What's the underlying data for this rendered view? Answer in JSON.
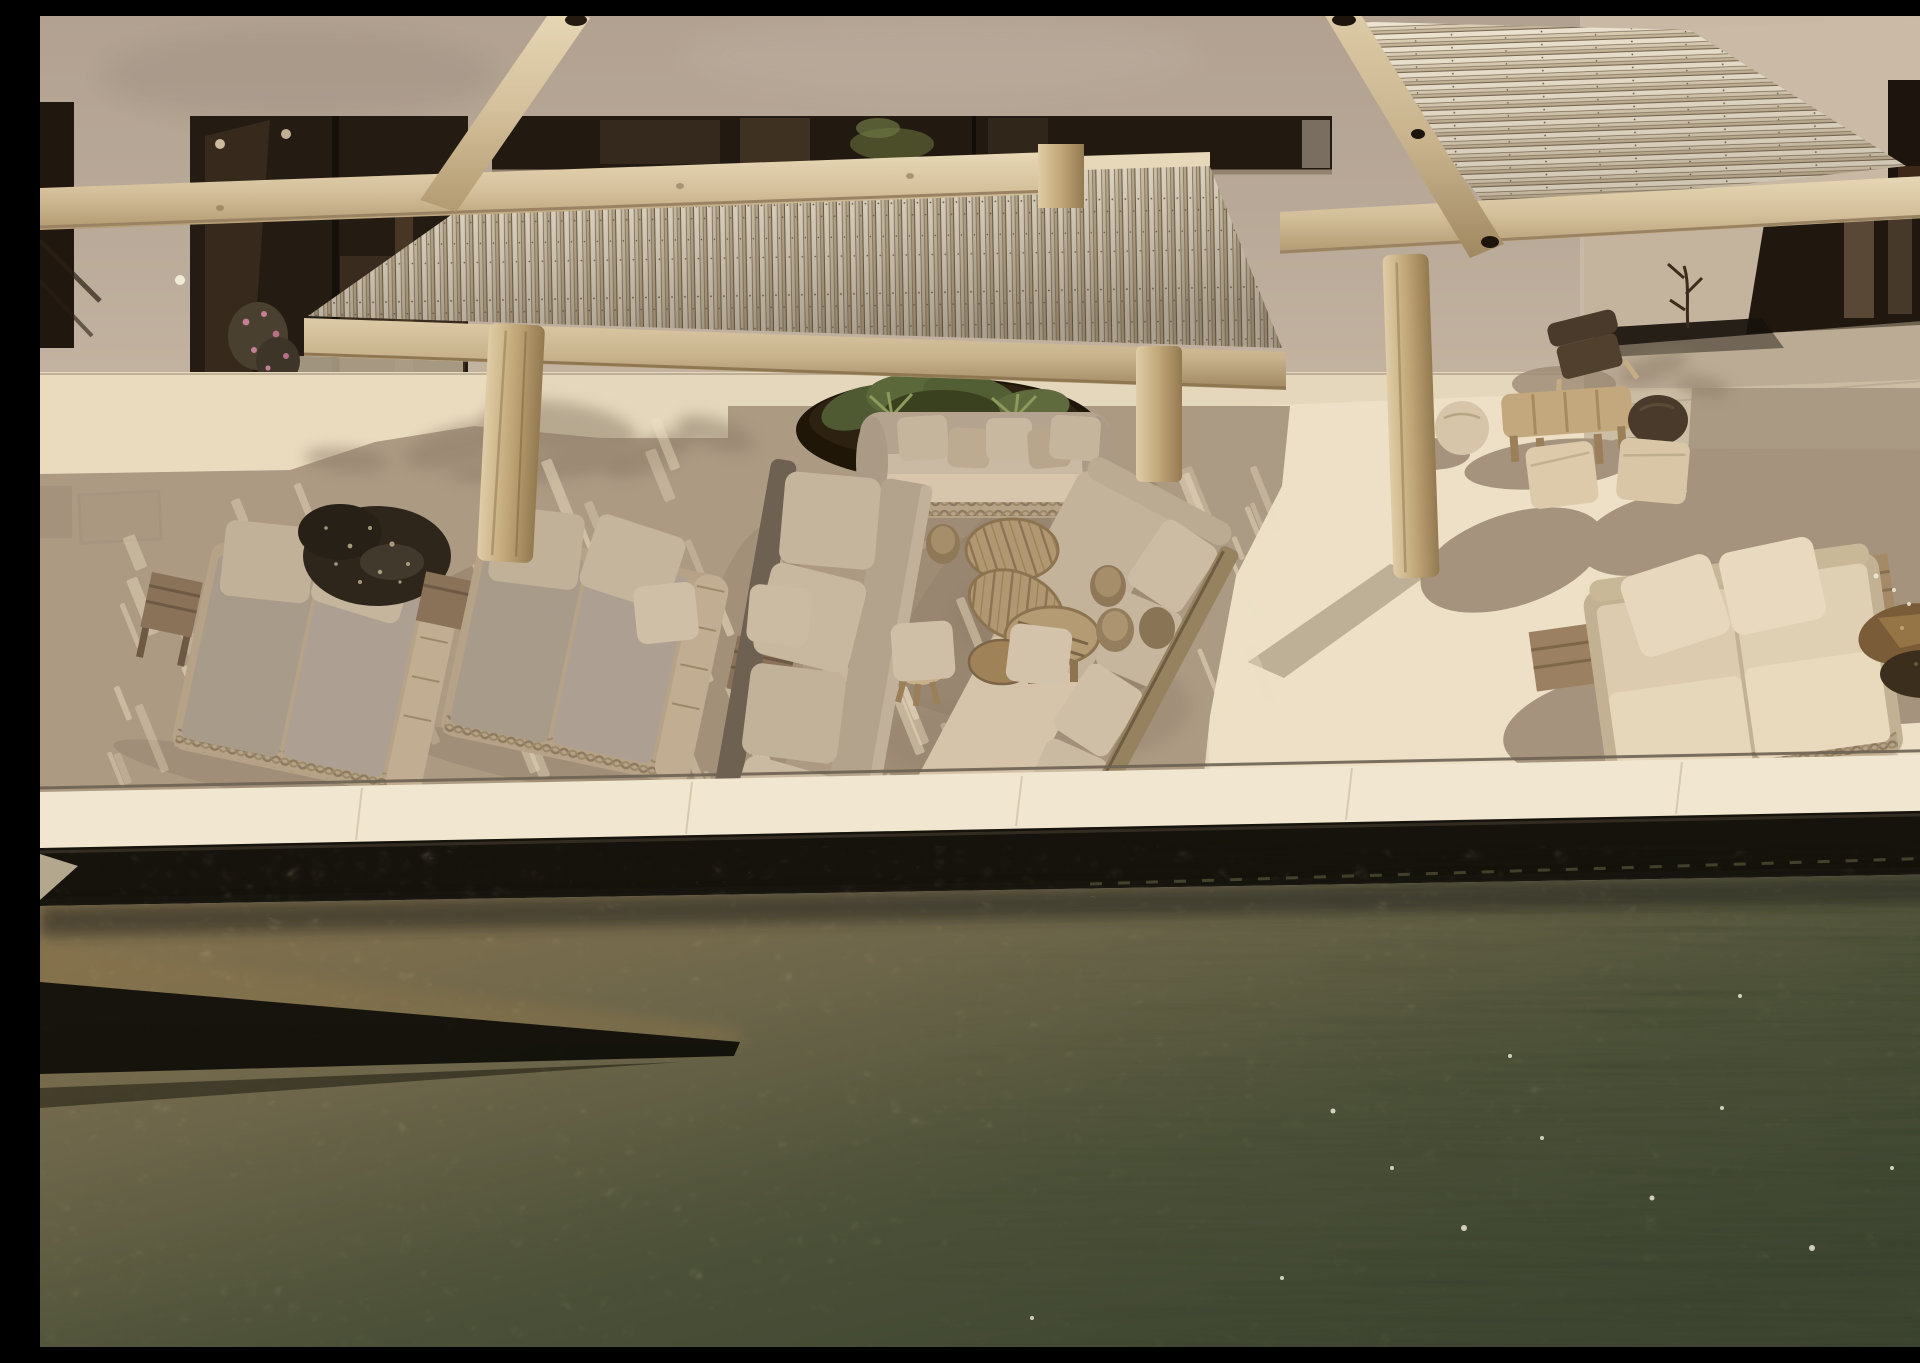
{
  "scene": {
    "description": "Aerial view of a Mediterranean villa terrace: stucco facade with dark glass doors, two whitewashed reed pergola canopies on timber beams, grey wicker sun loungers, outdoor sofas around round teak coffee tables, log stools, fabric poufs, a planter of agaves, stone boulders, and the dark green rippling water of an infinity pool along the bottom, all in strong afternoon sun with dappled shade.",
    "objects": [
      "stucco villa facade",
      "dark glass sliding doors",
      "reed pergola canopy",
      "timber pergola beams",
      "timber posts",
      "double sun loungers with grey cushions",
      "outdoor sofas with pillows",
      "round teak coffee tables",
      "log stools",
      "square fabric poufs",
      "round fabric poufs",
      "stone boulders",
      "planter with agaves",
      "dry sapling",
      "wall sconce",
      "flowering shrub",
      "travertine terrace with sun dapples",
      "pool coping",
      "infinity pool water"
    ],
    "colors": {
      "wall": "#b7a797",
      "wall-light": "#cbbaa5",
      "window": "#221910",
      "reed-hi": "#eae1cd",
      "reed-mid": "#d6c9b0",
      "reed-low": "#c2b297",
      "reed-gap": "#6e5f4b",
      "beam-hi": "#e3d2b0",
      "beam-lo": "#b49c74",
      "terrace": "#e5d7bc",
      "terrace-bright": "#efe2c9",
      "shade": "#a8967f",
      "shade-deep": "#8f7d68",
      "cushion": "#a99b8a",
      "pillow": "#c6b59d",
      "cream": "#dccbaf",
      "cream-hi": "#e8d9bf",
      "wicker": "#b5a287",
      "wood": "#b2946e",
      "wood-dark": "#8a7258",
      "log": "#8f7858",
      "rock": "#2e261b",
      "rock-brown": "#7a5c38",
      "green": "#57603a",
      "coping": "#f1e7d1",
      "pool-wall": "#16130d",
      "water-brown": "#8a7550",
      "water-olive": "#5d5e41",
      "water-green": "#3d4530",
      "dapple": "#eddfc2",
      "pink": "#c57f95"
    },
    "light": {
      "dapple_rotation": -22,
      "dapple_bands": [
        {
          "x": 60,
          "y": 430,
          "w": 250,
          "h": 330,
          "n": 20
        },
        {
          "x": 330,
          "y": 405,
          "w": 250,
          "h": 310,
          "n": 16
        },
        {
          "x": 600,
          "y": 395,
          "w": 330,
          "h": 360,
          "n": 22
        },
        {
          "x": 950,
          "y": 400,
          "w": 290,
          "h": 200,
          "n": 12
        },
        {
          "x": 620,
          "y": 610,
          "w": 330,
          "h": 150,
          "n": 8
        },
        {
          "x": 150,
          "y": 480,
          "w": 170,
          "h": 260,
          "n": 10
        },
        {
          "x": 1100,
          "y": 430,
          "w": 120,
          "h": 260,
          "n": 8
        }
      ],
      "tree_shadow_blobs": [
        {
          "cx": 425,
          "cy": 428,
          "rx": 62,
          "ry": 20,
          "rot": -15
        },
        {
          "cx": 520,
          "cy": 412,
          "rx": 78,
          "ry": 26,
          "rot": 8
        },
        {
          "cx": 612,
          "cy": 438,
          "rx": 48,
          "ry": 16,
          "rot": -25
        },
        {
          "cx": 306,
          "cy": 444,
          "rx": 42,
          "ry": 12,
          "rot": 5
        },
        {
          "cx": 676,
          "cy": 418,
          "rx": 40,
          "ry": 15,
          "rot": 18
        },
        {
          "cx": 500,
          "cy": 452,
          "rx": 92,
          "ry": 13,
          "rot": -5
        },
        {
          "cx": 1614,
          "cy": 352,
          "rx": 36,
          "ry": 13,
          "rot": -18
        },
        {
          "cx": 1662,
          "cy": 370,
          "rx": 28,
          "ry": 11,
          "rot": 12
        }
      ],
      "sparkles": [
        [
          1293,
          1095,
          2.5
        ],
        [
          1352,
          1152,
          2
        ],
        [
          1424,
          1212,
          3
        ],
        [
          1502,
          1122,
          2
        ],
        [
          1612,
          1182,
          2.5
        ],
        [
          1682,
          1092,
          2
        ],
        [
          1772,
          1232,
          3
        ],
        [
          1852,
          1152,
          2
        ],
        [
          1242,
          1262,
          2
        ],
        [
          992,
          1302,
          2
        ],
        [
          1470,
          1040,
          2
        ],
        [
          1700,
          980,
          2
        ],
        [
          1836,
          560,
          2.5
        ],
        [
          1854,
          574,
          2
        ],
        [
          1869,
          588,
          2
        ]
      ]
    }
  }
}
